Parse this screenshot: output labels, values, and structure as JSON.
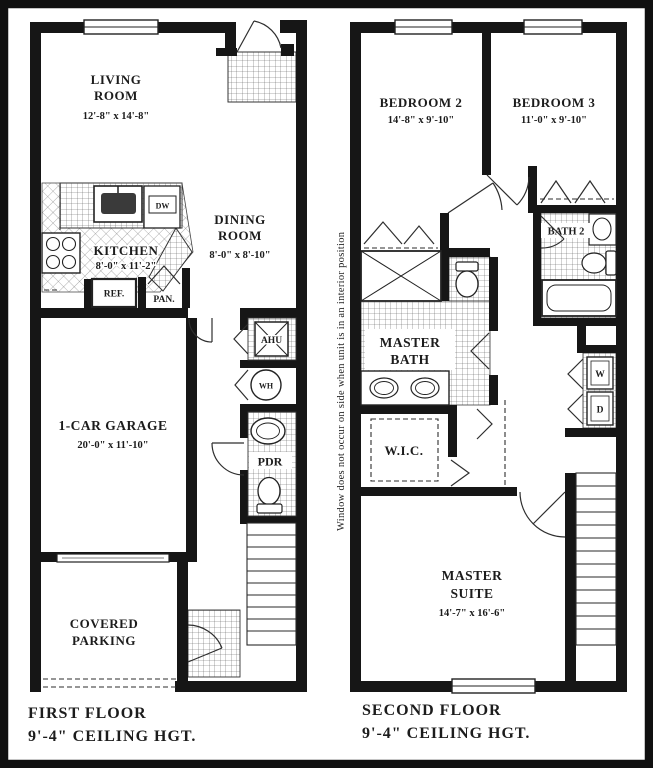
{
  "meta": {
    "type": "townhouse-floor-plan",
    "ink": "#1c1c1c",
    "paper": "#ffffff"
  },
  "floor1": {
    "title_line1": "FIRST FLOOR",
    "title_line2": "9'-4\" CEILING HGT.",
    "living_name1": "LIVING",
    "living_name2": "ROOM",
    "living_dims": "12'-8\" x 14'-8\"",
    "kitchen_name": "KITCHEN",
    "kitchen_dims": "8'-0\" x 11'-2\"",
    "dining_name1": "DINING",
    "dining_name2": "ROOM",
    "dining_dims": "8'-0\" x 8'-10\"",
    "garage_name": "1-CAR GARAGE",
    "garage_dims": "20'-0\" x 11'-10\"",
    "parking_name1": "COVERED",
    "parking_name2": "PARKING",
    "ahu": "AHU",
    "wh": "WH",
    "pdr": "PDR",
    "ref": "REF.",
    "pan": "PAN.",
    "dw": "DW"
  },
  "floor2": {
    "title_line1": "SECOND FLOOR",
    "title_line2": "9'-4\" CEILING HGT.",
    "note": "Window does not occur on side when unit is in an interior position",
    "bedroom2_name": "BEDROOM 2",
    "bedroom2_dims": "14'-8\" x 9'-10\"",
    "bedroom3_name": "BEDROOM 3",
    "bedroom3_dims": "11'-0\" x 9'-10\"",
    "bath2": "BATH 2",
    "mbath_name1": "MASTER",
    "mbath_name2": "BATH",
    "wic": "W.I.C.",
    "master_name1": "MASTER",
    "master_name2": "SUITE",
    "master_dims": "14'-7\" x 16'-6\"",
    "washer": "W",
    "dryer": "D"
  }
}
